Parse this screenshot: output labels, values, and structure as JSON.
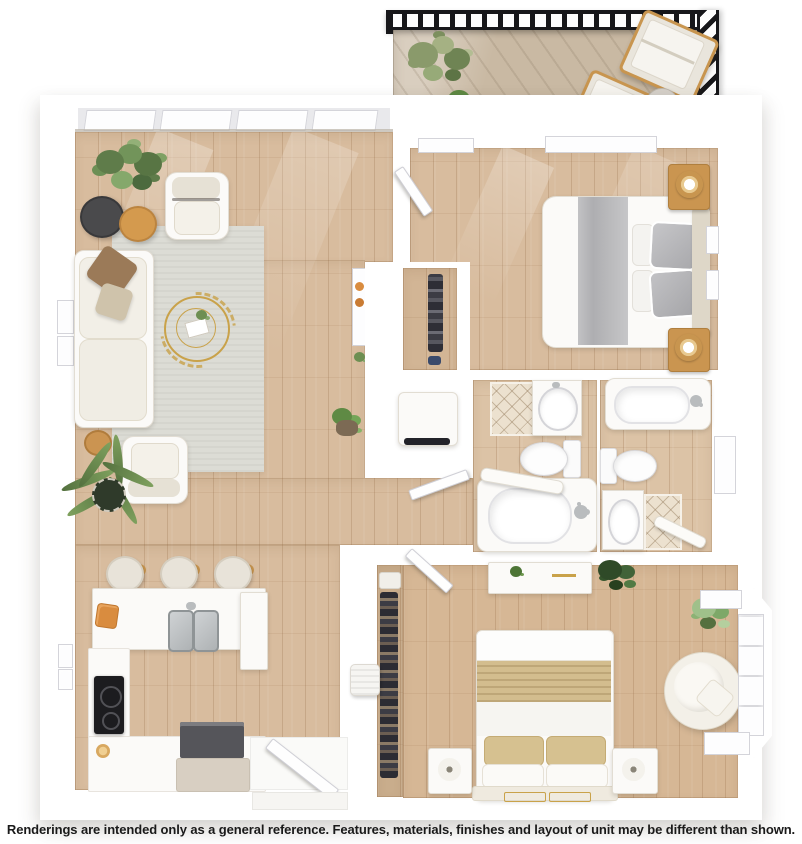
{
  "caption": {
    "disclaimer": "Renderings are intended only as a general reference. Features, materials, finishes and layout of unit may be different than shown."
  },
  "palette": {
    "wall": "#ffffff",
    "wood_floor": "#d8bc9e",
    "wood_floor_dark": "#c9ab8a",
    "balcony_floor": "#c9b9a3",
    "rug": "#dcdcd5",
    "upholstery_cream": "#efebe2",
    "accent_wood": "#c8954f",
    "gold": "#c9a24a",
    "plant_green": "#6d8f52",
    "plant_green_dark": "#3f5a35",
    "textile_tan": "#d3bd8e",
    "textile_gray": "#b6b6b8",
    "stove_black": "#1c1c1f",
    "steel": "#b9bcbe",
    "tile": "#ece1cf",
    "railing_black": "#17171a",
    "text": "#1a1a1a"
  }
}
